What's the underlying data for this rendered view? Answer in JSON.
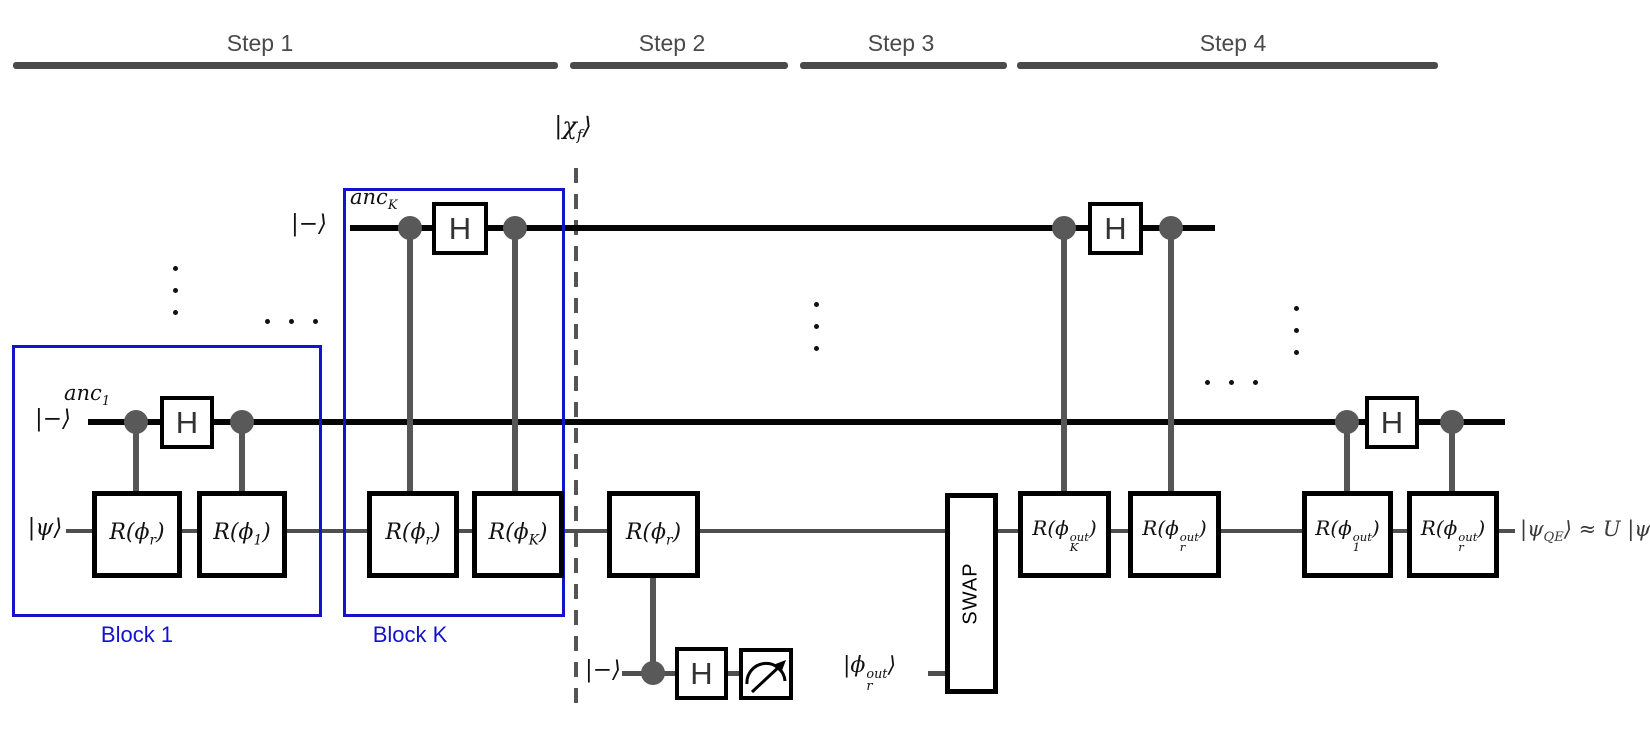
{
  "header": {
    "steps": [
      {
        "label": "Step 1"
      },
      {
        "label": "Step 2"
      },
      {
        "label": "Step 3"
      },
      {
        "label": "Step 4"
      }
    ]
  },
  "blocks": {
    "block1_label": "Block 1",
    "blockK_label": "Block K"
  },
  "state_labels": {
    "chi": {
      "pre": "|χ",
      "sub": "f",
      "post": "⟩"
    },
    "anc_K": {
      "pre": "anc",
      "sub": "K"
    },
    "anc_1": {
      "pre": "anc",
      "sub": "1"
    },
    "ket_minus": "|−⟩",
    "ket_psi": "|ψ⟩",
    "phi_r_out": {
      "pre": "|ϕ",
      "sub": "r",
      "sup": "out",
      "post": "⟩"
    },
    "output": {
      "pre": "|ψ",
      "sub": "QE",
      "post": "⟩ ≈ U |ψ⟩"
    }
  },
  "gates": {
    "hadamard": "H",
    "swap": "SWAP",
    "r_phi_r": {
      "pre": "R(ϕ",
      "sub": "r",
      "post": ")"
    },
    "r_phi_1": {
      "pre": "R(ϕ",
      "sub": "1",
      "post": ")"
    },
    "r_phi_K": {
      "pre": "R(ϕ",
      "sub": "K",
      "post": ")"
    },
    "r_phi_K_out": {
      "pre": "R(ϕ",
      "sub": "K",
      "sup": "out",
      "post": ")"
    },
    "r_phi_r_out": {
      "pre": "R(ϕ",
      "sub": "r",
      "sup": "out",
      "post": ")"
    },
    "r_phi_1_out": {
      "pre": "R(ϕ",
      "sub": "1",
      "sup": "out",
      "post": ")"
    }
  },
  "icons": {
    "measurement": "meter-dial-arrow",
    "ellipsis_vertical": "⋮",
    "ellipsis_horizontal": "⋯",
    "control_dot": "filled-circle"
  },
  "colors": {
    "block_blue": "#1313cb",
    "wire_black": "#050505",
    "wire_gray": "#4f4f4f",
    "control_gray": "#595959",
    "step_gray": "#4a4a4a",
    "output_text": "#3a3a3a"
  }
}
